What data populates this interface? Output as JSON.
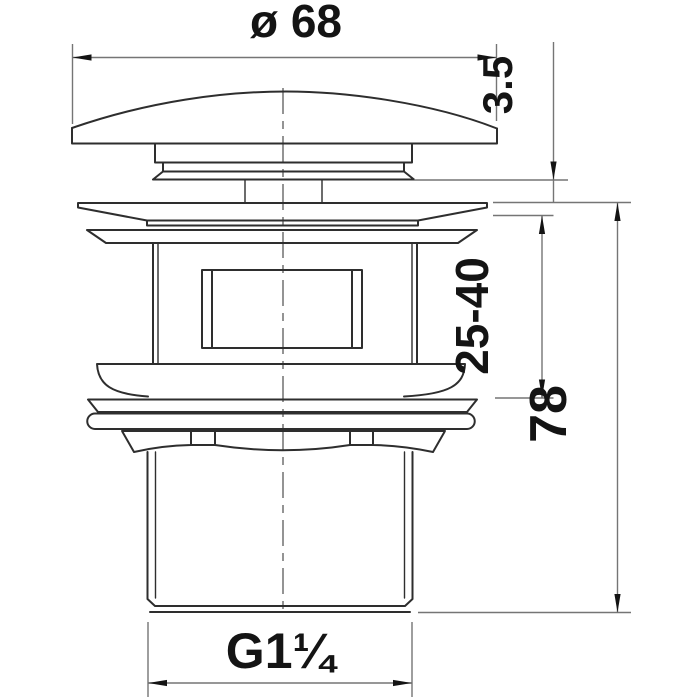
{
  "drawing": {
    "labels": {
      "diameter": "ø 68",
      "cap_gap": "3.5",
      "clamp_range": "25-40",
      "overall_height": "78",
      "thread": "G1¼"
    },
    "colors": {
      "background": "#ffffff",
      "object_line": "#2e2e2e",
      "dimension_line": "#757575",
      "text": "#141414"
    }
  }
}
